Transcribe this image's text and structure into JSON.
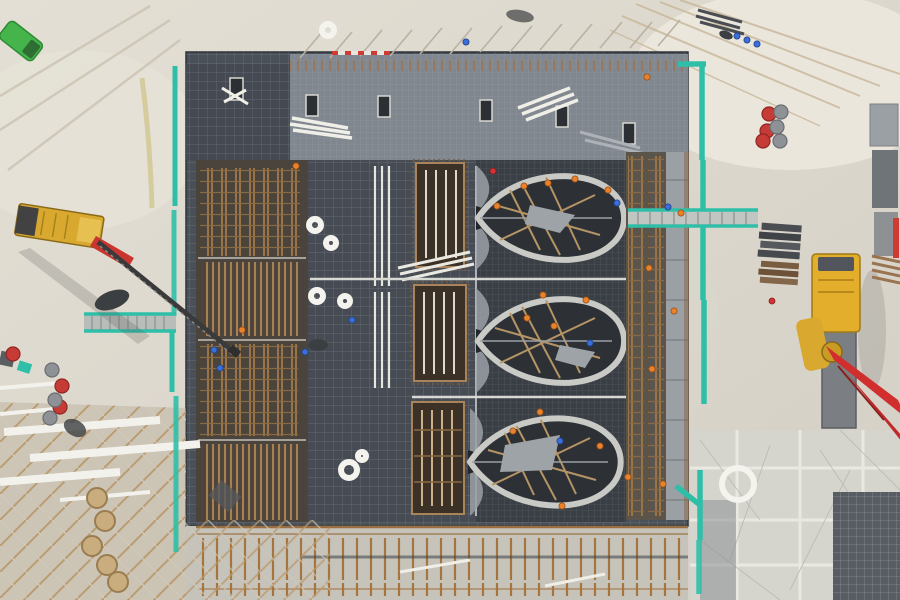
{
  "meta": {
    "description": "Aerial top-down drone photo of a building foundation under construction: dark rebar slab with three leaf-shaped formwork pits, teal site fencing, a mobile lattice-boom crane at left, a concrete pump truck with red boom at right, scaffolding, barrels, cable coils and workers."
  },
  "palette": {
    "ground": "#ddd8cd",
    "ground_light": "#eae6dc",
    "ground_dark": "#cfcabe",
    "concrete_pad": "#d5d5cd",
    "slab_dark": "#4a5058",
    "slab_darker": "#3a3f46",
    "slab_top": "#81878f",
    "eye_fill": "#2d3136",
    "eye_rim": "#c9cac5",
    "rust": "#9a7450",
    "wood": "#b59465",
    "teal": "#2fbfa8",
    "crane_yellow": "#d9a82e",
    "truck_yellow": "#e3ae2b",
    "boom_red": "#d02f2e",
    "machine_red": "#c8362f",
    "green_truck": "#45b44b",
    "white_plank": "#efeee7",
    "steel_dark": "#4a4d52",
    "walk_gray": "#9aa0a4"
  },
  "markers": [
    {
      "name": "workers-blue",
      "shape": "circle",
      "r": 3.1,
      "fill": "#3a6fd8",
      "stroke": "#1e3f8a",
      "sw": 0.8,
      "points": [
        [
          737,
          36
        ],
        [
          747,
          40
        ],
        [
          757,
          44
        ],
        [
          466,
          42
        ],
        [
          668,
          207
        ],
        [
          617,
          203
        ],
        [
          590,
          343
        ],
        [
          560,
          441
        ],
        [
          352,
          320
        ],
        [
          305,
          352
        ],
        [
          214,
          350
        ],
        [
          220,
          368
        ]
      ]
    },
    {
      "name": "workers-orange",
      "shape": "circle",
      "r": 3.1,
      "fill": "#e8822c",
      "stroke": "#9c4f12",
      "sw": 0.8,
      "points": [
        [
          296,
          166
        ],
        [
          242,
          330
        ],
        [
          497,
          206
        ],
        [
          524,
          186
        ],
        [
          548,
          183
        ],
        [
          575,
          179
        ],
        [
          608,
          190
        ],
        [
          543,
          295
        ],
        [
          527,
          318
        ],
        [
          554,
          326
        ],
        [
          586,
          300
        ],
        [
          540,
          412
        ],
        [
          513,
          431
        ],
        [
          562,
          506
        ],
        [
          600,
          446
        ],
        [
          628,
          477
        ],
        [
          649,
          268
        ],
        [
          681,
          213
        ],
        [
          674,
          311
        ],
        [
          652,
          369
        ],
        [
          647,
          77
        ],
        [
          663,
          484
        ]
      ]
    },
    {
      "name": "workers-red",
      "shape": "circle",
      "r": 3,
      "fill": "#d23434",
      "stroke": "#821c1c",
      "sw": 0.8,
      "points": [
        [
          493,
          171
        ],
        [
          772,
          301
        ]
      ]
    },
    {
      "name": "barrels-red",
      "shape": "circle",
      "r": 7,
      "fill": "#c63b35",
      "stroke": "#8e2722",
      "sw": 1.2,
      "points": [
        [
          769,
          114
        ],
        [
          767,
          131
        ],
        [
          763,
          141
        ],
        [
          62,
          386
        ],
        [
          60,
          407
        ],
        [
          13,
          354
        ]
      ]
    },
    {
      "name": "barrels-gray",
      "shape": "circle",
      "r": 7,
      "fill": "#8e9296",
      "stroke": "#6a6e72",
      "sw": 1.2,
      "points": [
        [
          781,
          112
        ],
        [
          777,
          127
        ],
        [
          780,
          141
        ],
        [
          52,
          370
        ],
        [
          55,
          400
        ],
        [
          50,
          418
        ]
      ]
    },
    {
      "name": "wood-coils",
      "shape": "circle",
      "r": 10,
      "fill": "#c9ad7e",
      "stroke": "#9a7d4f",
      "sw": 2,
      "points": [
        [
          97,
          498
        ],
        [
          105,
          521
        ],
        [
          92,
          546
        ],
        [
          107,
          565
        ],
        [
          118,
          582
        ]
      ]
    },
    {
      "name": "cable-rings",
      "shape": "ring",
      "r": 8,
      "fill": "none",
      "stroke": "#f4f3ee",
      "sw": 6,
      "points": [
        [
          738,
          484,
          16
        ],
        [
          349,
          470,
          8
        ],
        [
          317,
          296,
          6
        ],
        [
          345,
          301,
          5
        ],
        [
          315,
          225,
          6
        ],
        [
          331,
          243,
          5
        ],
        [
          328,
          30,
          6
        ],
        [
          362,
          456,
          4
        ]
      ]
    }
  ]
}
